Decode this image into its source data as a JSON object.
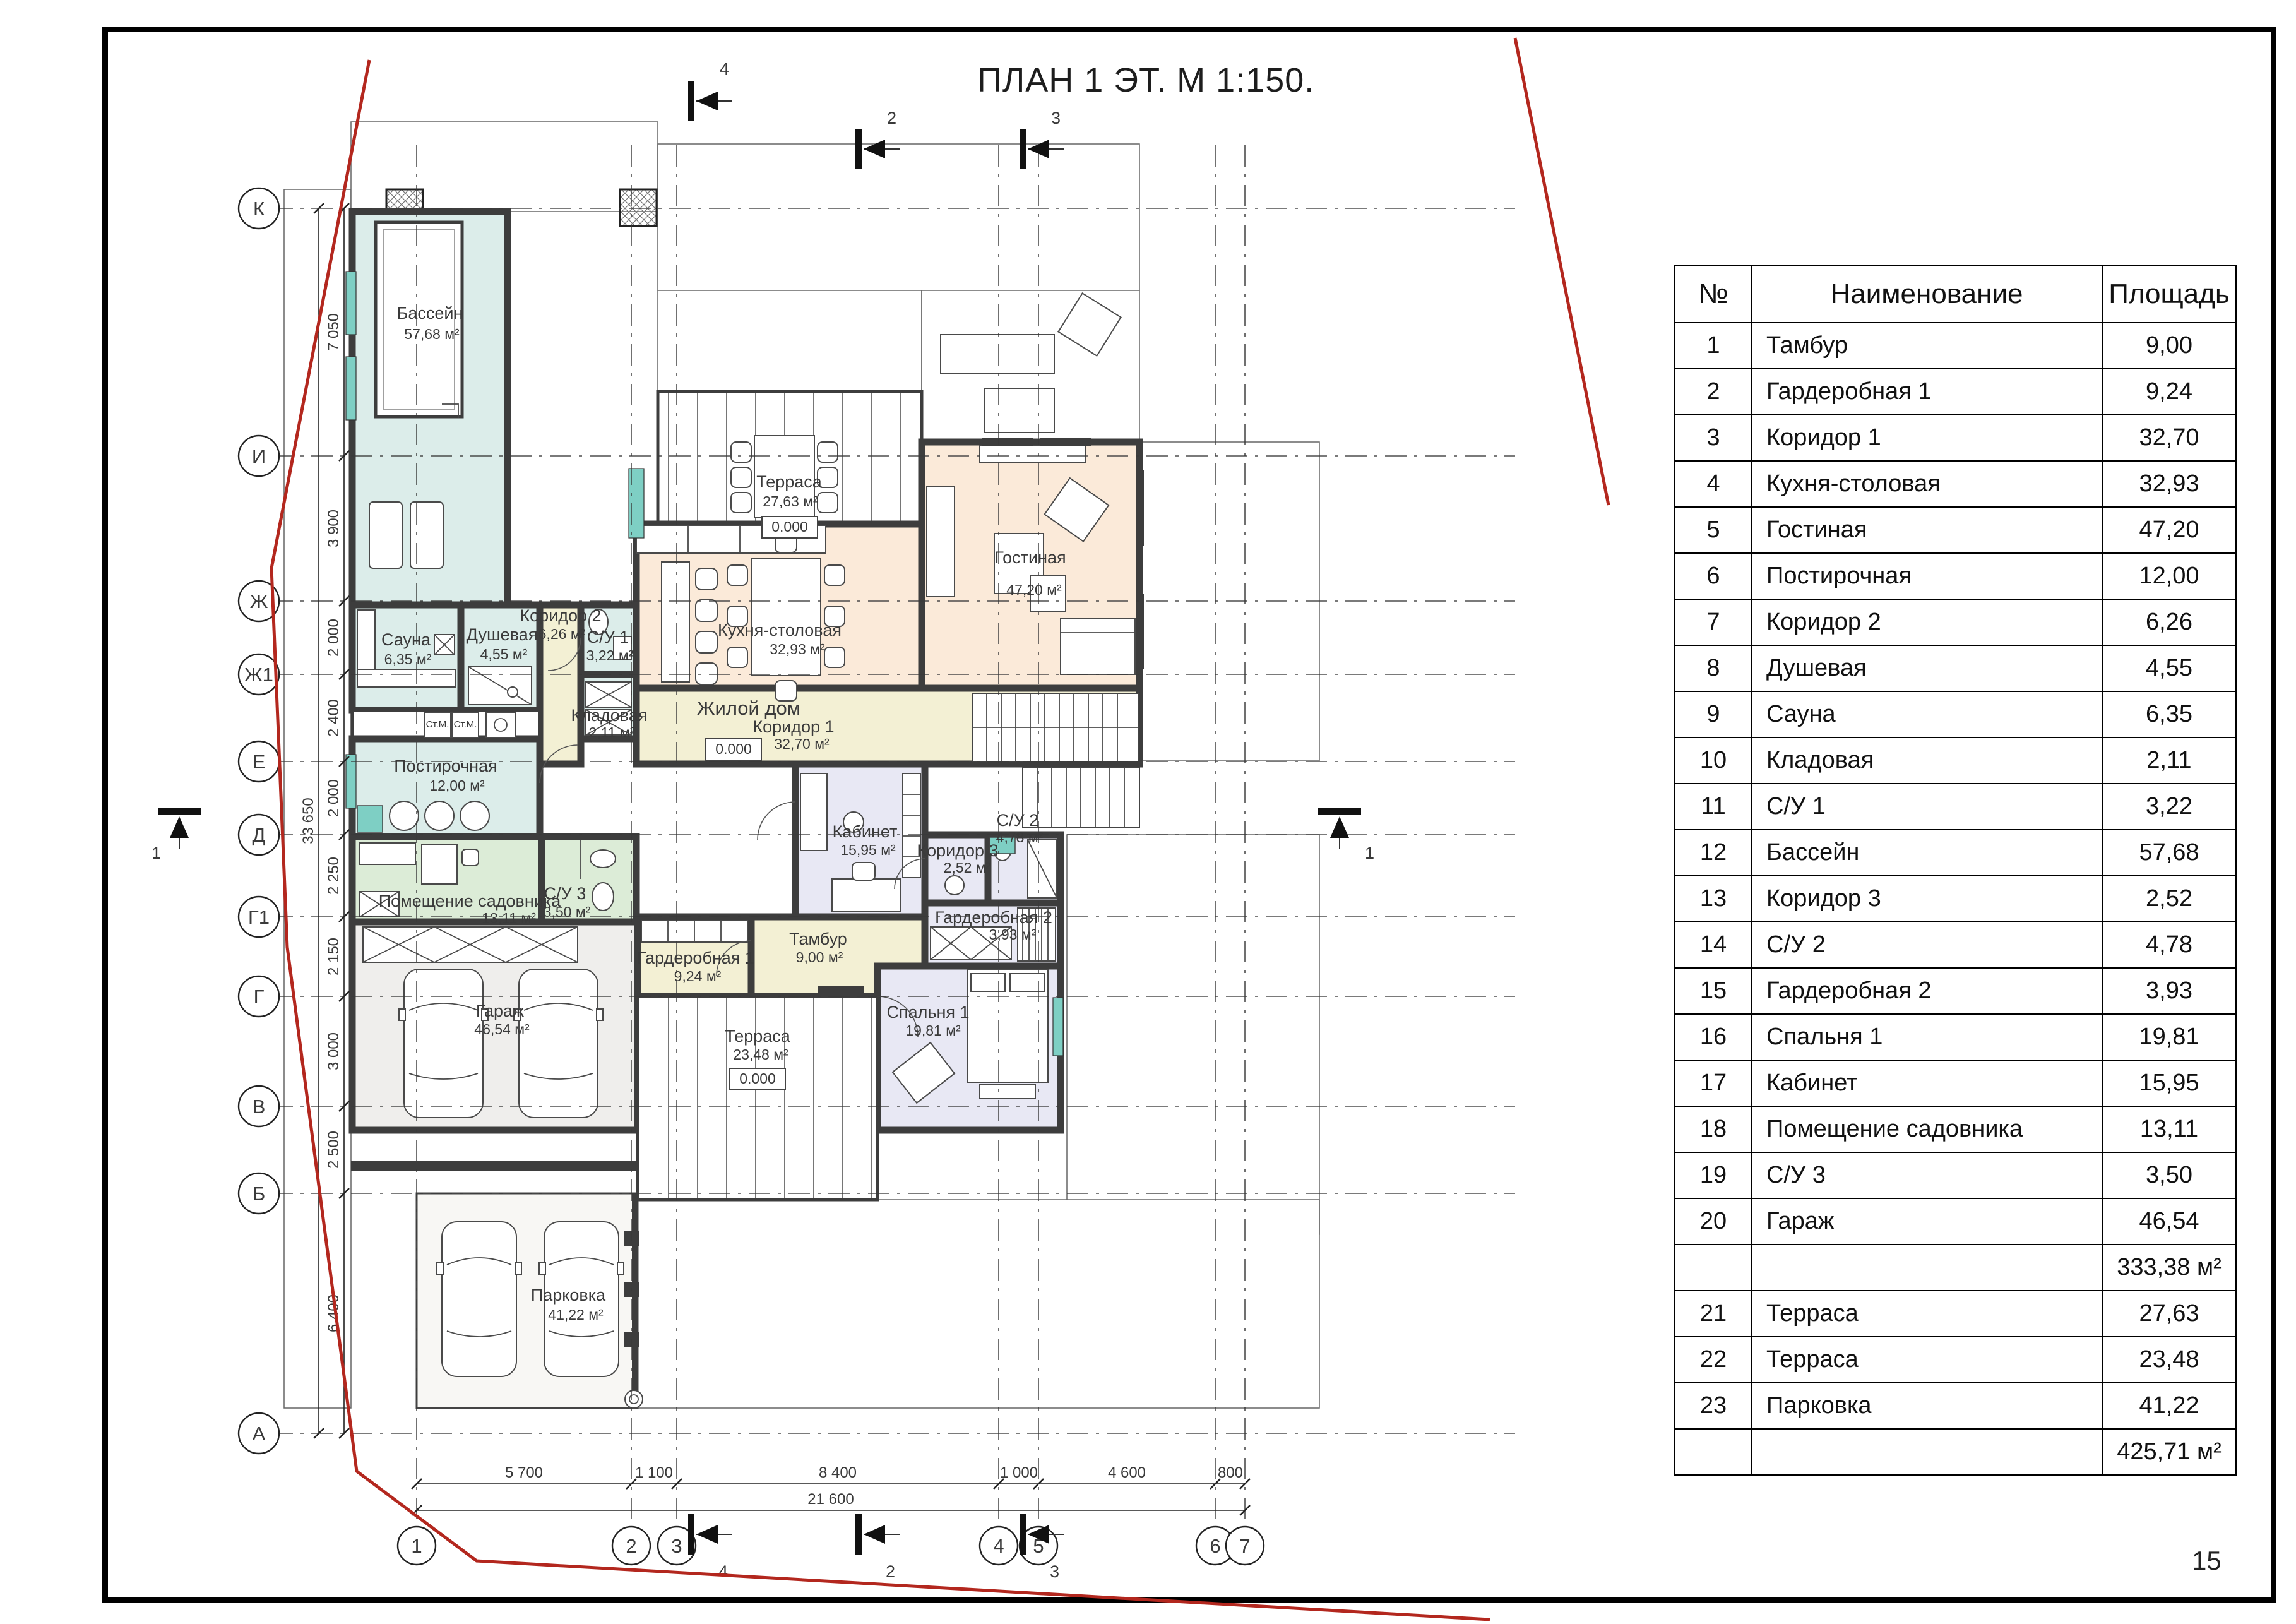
{
  "page": {
    "title": "ПЛАН 1 ЭТ. М 1:150.",
    "number": "15"
  },
  "table": {
    "headers": {
      "num": "№",
      "name": "Наименование",
      "area": "Площадь"
    },
    "rows": [
      {
        "num": "1",
        "name": "Тамбур",
        "area": "9,00"
      },
      {
        "num": "2",
        "name": "Гардеробная 1",
        "area": "9,24"
      },
      {
        "num": "3",
        "name": "Коридор 1",
        "area": "32,70"
      },
      {
        "num": "4",
        "name": "Кухня-столовая",
        "area": "32,93"
      },
      {
        "num": "5",
        "name": "Гостиная",
        "area": "47,20"
      },
      {
        "num": "6",
        "name": "Постирочная",
        "area": "12,00"
      },
      {
        "num": "7",
        "name": "Коридор 2",
        "area": "6,26"
      },
      {
        "num": "8",
        "name": "Душевая",
        "area": "4,55"
      },
      {
        "num": "9",
        "name": "Сауна",
        "area": "6,35"
      },
      {
        "num": "10",
        "name": "Кладовая",
        "area": "2,11"
      },
      {
        "num": "11",
        "name": "С/У 1",
        "area": "3,22"
      },
      {
        "num": "12",
        "name": "Бассейн",
        "area": "57,68"
      },
      {
        "num": "13",
        "name": "Коридор 3",
        "area": "2,52"
      },
      {
        "num": "14",
        "name": "С/У 2",
        "area": "4,78"
      },
      {
        "num": "15",
        "name": "Гардеробная 2",
        "area": "3,93"
      },
      {
        "num": "16",
        "name": "Спальня 1",
        "area": "19,81"
      },
      {
        "num": "17",
        "name": "Кабинет",
        "area": "15,95"
      },
      {
        "num": "18",
        "name": "Помещение садовника",
        "area": "13,11"
      },
      {
        "num": "19",
        "name": "С/У 3",
        "area": "3,50"
      },
      {
        "num": "20",
        "name": "Гараж",
        "area": "46,54"
      },
      {
        "num": "21",
        "name": "Терраса",
        "area": "27,63"
      },
      {
        "num": "22",
        "name": "Терраса",
        "area": "23,48"
      },
      {
        "num": "23",
        "name": "Парковка",
        "area": "41,22"
      }
    ],
    "subtotal": "333,38 м²",
    "total": "425,71 м²"
  },
  "plan": {
    "building_label": "Жилой дом",
    "level_mark": "0.000",
    "washer_label": "Ст.М.",
    "rooms": [
      {
        "name": "Бассейн",
        "area": "57,68 м²"
      },
      {
        "name": "Терраса",
        "area": "27,63 м²"
      },
      {
        "name": "Гостиная",
        "area": "47,20 м²"
      },
      {
        "name": "Кухня-столовая",
        "area": "32,93 м²"
      },
      {
        "name": "Сауна",
        "area": "6,35 м²"
      },
      {
        "name": "Душевая",
        "area": "4,55 м²"
      },
      {
        "name": "Коридор 2",
        "area": "6,26 м²"
      },
      {
        "name": "С/У 1",
        "area": "3,22 м²"
      },
      {
        "name": "Кладовая",
        "area": "2,11 м²"
      },
      {
        "name": "Постирочная",
        "area": "12,00 м²"
      },
      {
        "name": "Коридор 1",
        "area": "32,70 м²"
      },
      {
        "name": "Помещение садовника",
        "area": "13,11 м²"
      },
      {
        "name": "С/У 3",
        "area": "3,50 м²"
      },
      {
        "name": "Гараж",
        "area": "46,54 м²"
      },
      {
        "name": "Тамбур",
        "area": "9,00 м²"
      },
      {
        "name": "Гардеробная 1",
        "area": "9,24 м²"
      },
      {
        "name": "Кабинет",
        "area": "15,95 м²"
      },
      {
        "name": "Коридор 3",
        "area": "2,52 м²"
      },
      {
        "name": "С/У 2",
        "area": "4,78 м²"
      },
      {
        "name": "Гардеробная 2",
        "area": "3,93 м²"
      },
      {
        "name": "Спальня 1",
        "area": "19,81 м²"
      },
      {
        "name": "Терраса",
        "area": "23,48 м²"
      },
      {
        "name": "Парковка",
        "area": "41,22 м²"
      }
    ],
    "axes": {
      "horizontal": [
        "К",
        "И",
        "Ж",
        "Ж1",
        "Е",
        "Д",
        "Г1",
        "Г",
        "В",
        "Б",
        "А"
      ],
      "vertical": [
        "1",
        "2",
        "3",
        "4",
        "5",
        "6",
        "7"
      ]
    },
    "dims": {
      "left": [
        "7 050",
        "3 900",
        "2 000",
        "2 400",
        "2 000",
        "2 250",
        "2 150",
        "3 000",
        "2 500",
        "6 400"
      ],
      "left_total": "33 650",
      "bottom": [
        "5 700",
        "1 100",
        "8 400",
        "1 000",
        "4 600",
        "800"
      ],
      "bottom_total": "21 600"
    },
    "sections": {
      "s1": "1",
      "s2": "2",
      "s3": "3",
      "s4": "4"
    }
  },
  "colors": {
    "wall": "#3d3d3d",
    "pool": "#dcedea",
    "living": "#fbead9",
    "corridor": "#f3f0d4",
    "bedroom_block": "#e8e8f4",
    "green": "#dcecd7",
    "garage": "#efeeec",
    "boundary_red": "#b3271e",
    "teal": "#7ecfc4"
  }
}
